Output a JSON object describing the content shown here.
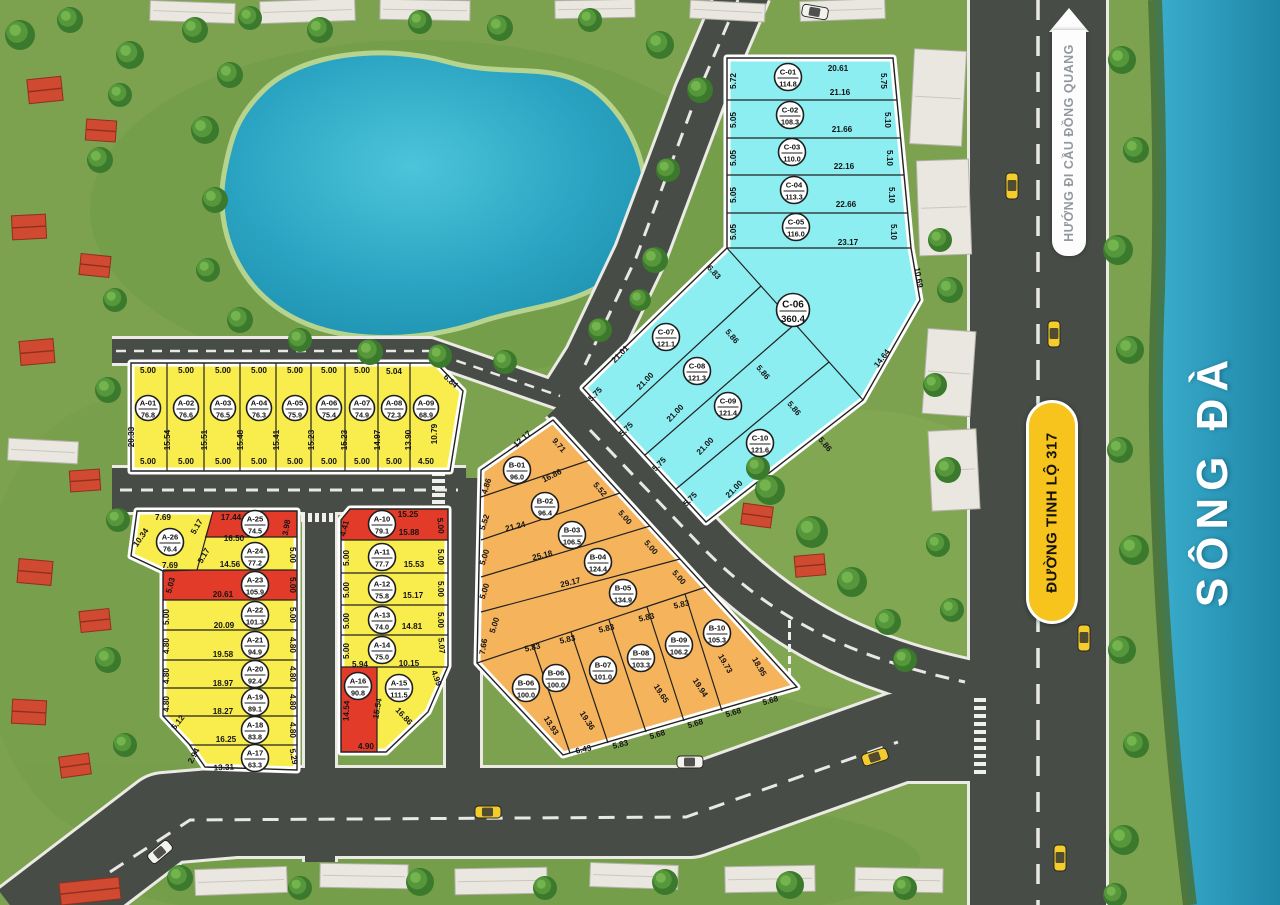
{
  "palette": {
    "plot_yellow": "#f9ed4e",
    "plot_red": "#e23b2a",
    "plot_orange": "#f5b45b",
    "plot_cyan": "#8deef2",
    "road_gray": "#474c47",
    "grass_green": "#7ca24f",
    "water_blue": "#2b9fc0",
    "sign_yellow": "#f6c41c"
  },
  "signs": {
    "road": "ĐƯỜNG TINH LỘ 317",
    "direction": "HƯỚNG ĐI CẦU ĐỒNG QUANG",
    "river": "SÔNG ĐÀ"
  },
  "plots": [
    [
      "A-01",
      "76.8",
      "y",
      148,
      408
    ],
    [
      "A-02",
      "76.6",
      "y",
      186,
      408
    ],
    [
      "A-03",
      "76.5",
      "y",
      223,
      408
    ],
    [
      "A-04",
      "76.3",
      "y",
      259,
      408
    ],
    [
      "A-05",
      "75.9",
      "y",
      295,
      408
    ],
    [
      "A-06",
      "75.4",
      "y",
      329,
      408
    ],
    [
      "A-07",
      "74.9",
      "y",
      362,
      408
    ],
    [
      "A-08",
      "72.3",
      "y",
      394,
      408
    ],
    [
      "A-09",
      "68.9",
      "y",
      426,
      408
    ],
    [
      "A-10",
      "79.1",
      "r",
      382,
      524
    ],
    [
      "A-11",
      "77.7",
      "y",
      382,
      557
    ],
    [
      "A-12",
      "75.8",
      "y",
      382,
      589
    ],
    [
      "A-13",
      "74.0",
      "y",
      382,
      620
    ],
    [
      "A-14",
      "75.0",
      "y",
      382,
      650
    ],
    [
      "A-15",
      "111.5",
      "y",
      399,
      688
    ],
    [
      "A-16",
      "90.8",
      "r",
      358,
      686
    ],
    [
      "A-17",
      "63.3",
      "y",
      255,
      758
    ],
    [
      "A-18",
      "83.8",
      "y",
      255,
      730
    ],
    [
      "A-19",
      "89.1",
      "y",
      255,
      702
    ],
    [
      "A-20",
      "92.4",
      "y",
      255,
      674
    ],
    [
      "A-21",
      "94.9",
      "y",
      255,
      645
    ],
    [
      "A-22",
      "101.3",
      "y",
      255,
      615
    ],
    [
      "A-23",
      "105.9",
      "r",
      255,
      585
    ],
    [
      "A-24",
      "77.2",
      "y",
      255,
      556
    ],
    [
      "A-25",
      "74.5",
      "r",
      255,
      524
    ],
    [
      "A-26",
      "76.4",
      "y",
      170,
      542
    ],
    [
      "B-01",
      "96.0",
      "o",
      517,
      470
    ],
    [
      "B-02",
      "96.4",
      "o",
      545,
      506
    ],
    [
      "B-03",
      "106.5",
      "o",
      572,
      535
    ],
    [
      "B-04",
      "124.4",
      "o",
      598,
      562
    ],
    [
      "B-05",
      "134.9",
      "o",
      623,
      593
    ],
    [
      "B-06",
      "100.0",
      "o",
      526,
      688
    ],
    [
      "B-06",
      "100.0",
      "o",
      556,
      678
    ],
    [
      "B-07",
      "101.0",
      "o",
      603,
      670
    ],
    [
      "B-08",
      "103.3",
      "o",
      641,
      658
    ],
    [
      "B-09",
      "106.2",
      "o",
      679,
      645
    ],
    [
      "B-10",
      "105.3",
      "o",
      717,
      633
    ],
    [
      "C-01",
      "114.8",
      "c",
      788,
      77
    ],
    [
      "C-02",
      "108.3",
      "c",
      790,
      115
    ],
    [
      "C-03",
      "110.0",
      "c",
      792,
      152
    ],
    [
      "C-04",
      "113.3",
      "c",
      794,
      190
    ],
    [
      "C-05",
      "116.0",
      "c",
      796,
      227
    ],
    [
      "C-06",
      "360.4",
      "c",
      793,
      310
    ],
    [
      "C-07",
      "121.1",
      "c",
      666,
      337
    ],
    [
      "C-08",
      "121.3",
      "c",
      697,
      371
    ],
    [
      "C-09",
      "121.4",
      "c",
      728,
      406
    ],
    [
      "C-10",
      "121.6",
      "c",
      760,
      443
    ]
  ],
  "dims": [
    [
      "5.00",
      148,
      373,
      0
    ],
    [
      "5.00",
      186,
      373,
      0
    ],
    [
      "5.00",
      223,
      373,
      0
    ],
    [
      "5.00",
      259,
      373,
      0
    ],
    [
      "5.00",
      295,
      373,
      0
    ],
    [
      "5.00",
      329,
      373,
      0
    ],
    [
      "5.00",
      362,
      373,
      0
    ],
    [
      "5.04",
      394,
      374,
      0
    ],
    [
      "6.84",
      449,
      383,
      42
    ],
    [
      "5.00",
      148,
      464,
      0
    ],
    [
      "5.00",
      186,
      464,
      0
    ],
    [
      "5.00",
      223,
      464,
      0
    ],
    [
      "5.00",
      259,
      464,
      0
    ],
    [
      "5.00",
      295,
      464,
      0
    ],
    [
      "5.00",
      329,
      464,
      0
    ],
    [
      "5.00",
      362,
      464,
      0
    ],
    [
      "5.00",
      394,
      464,
      0
    ],
    [
      "4.50",
      426,
      464,
      0
    ],
    [
      "20.33",
      134,
      437,
      -90
    ],
    [
      "15.54",
      170,
      440,
      -90
    ],
    [
      "15.51",
      207,
      440,
      -90
    ],
    [
      "15.48",
      243,
      440,
      -90
    ],
    [
      "15.41",
      279,
      440,
      -90
    ],
    [
      "15.23",
      314,
      440,
      -90
    ],
    [
      "15.23",
      347,
      440,
      -90
    ],
    [
      "14.97",
      380,
      440,
      -90
    ],
    [
      "13.90",
      411,
      440,
      -90
    ],
    [
      "10.79",
      437,
      434,
      -90
    ],
    [
      "7.69",
      163,
      520,
      0
    ],
    [
      "17.44",
      231,
      520,
      0
    ],
    [
      "5.17",
      199,
      528,
      -60
    ],
    [
      "3.98",
      289,
      528,
      -80
    ],
    [
      "10.34",
      143,
      539,
      -55
    ],
    [
      "16.50",
      234,
      541,
      0
    ],
    [
      "5.17",
      206,
      557,
      -60
    ],
    [
      "14.56",
      230,
      567,
      0
    ],
    [
      "5.00",
      290,
      555,
      90
    ],
    [
      "7.69",
      170,
      568,
      0
    ],
    [
      "5.03",
      173,
      586,
      -75
    ],
    [
      "20.61",
      223,
      597,
      0
    ],
    [
      "5.00",
      290,
      585,
      90
    ],
    [
      "5.00",
      169,
      617,
      -90
    ],
    [
      "20.09",
      224,
      628,
      0
    ],
    [
      "5.00",
      290,
      615,
      90
    ],
    [
      "4.80",
      169,
      646,
      -90
    ],
    [
      "19.58",
      223,
      657,
      0
    ],
    [
      "4.80",
      290,
      645,
      90
    ],
    [
      "4.80",
      169,
      676,
      -90
    ],
    [
      "18.97",
      223,
      686,
      0
    ],
    [
      "4.80",
      290,
      674,
      90
    ],
    [
      "4.80",
      169,
      704,
      -90
    ],
    [
      "18.27",
      223,
      714,
      0
    ],
    [
      "4.80",
      290,
      702,
      90
    ],
    [
      "5.12",
      180,
      724,
      -52
    ],
    [
      "16.25",
      226,
      742,
      0
    ],
    [
      "4.80",
      290,
      730,
      90
    ],
    [
      "2.94",
      196,
      757,
      -62
    ],
    [
      "13.31",
      224,
      770,
      -3
    ],
    [
      "5.29",
      291,
      757,
      80
    ],
    [
      "15.25",
      408,
      517,
      0
    ],
    [
      "15.88",
      409,
      535,
      0
    ],
    [
      "4.41",
      347,
      529,
      -75
    ],
    [
      "5.00",
      438,
      526,
      85
    ],
    [
      "5.00",
      349,
      558,
      -90
    ],
    [
      "15.53",
      414,
      567,
      0
    ],
    [
      "5.00",
      438,
      557,
      90
    ],
    [
      "5.00",
      349,
      590,
      -90
    ],
    [
      "15.17",
      413,
      598,
      0
    ],
    [
      "5.00",
      438,
      589,
      90
    ],
    [
      "5.00",
      349,
      621,
      -90
    ],
    [
      "14.81",
      412,
      629,
      0
    ],
    [
      "5.00",
      438,
      620,
      90
    ],
    [
      "5.00",
      349,
      651,
      -90
    ],
    [
      "5.07",
      439,
      646,
      85
    ],
    [
      "5.94",
      360,
      667,
      0
    ],
    [
      "10.15",
      409,
      666,
      0
    ],
    [
      "4.99",
      434,
      679,
      70
    ],
    [
      "14.54",
      349,
      711,
      -87
    ],
    [
      "15.54",
      380,
      709,
      -80
    ],
    [
      "16.86",
      402,
      718,
      47
    ],
    [
      "4.90",
      366,
      749,
      0
    ],
    [
      "12.17",
      524,
      441,
      -42
    ],
    [
      "9.71",
      557,
      447,
      49
    ],
    [
      "4.86",
      489,
      487,
      -72
    ],
    [
      "16.86",
      553,
      478,
      -27
    ],
    [
      "5.52",
      487,
      523,
      -72
    ],
    [
      "21.24",
      516,
      529,
      -14
    ],
    [
      "5.52",
      598,
      491,
      49
    ],
    [
      "5.00",
      487,
      558,
      -72
    ],
    [
      "25.18",
      543,
      558,
      -14
    ],
    [
      "5.00",
      623,
      519,
      49
    ],
    [
      "5.00",
      487,
      592,
      -72
    ],
    [
      "29.17",
      571,
      585,
      -14
    ],
    [
      "5.00",
      649,
      549,
      49
    ],
    [
      "5.00",
      497,
      626,
      -72
    ],
    [
      "5.00",
      677,
      579,
      49
    ],
    [
      "7.66",
      486,
      647,
      -80
    ],
    [
      "5.83",
      533,
      650,
      -13
    ],
    [
      "5.83",
      568,
      642,
      -13
    ],
    [
      "5.83",
      607,
      631,
      -13
    ],
    [
      "5.83",
      647,
      620,
      -13
    ],
    [
      "5.83",
      682,
      607,
      -13
    ],
    [
      "13.93",
      549,
      727,
      57
    ],
    [
      "19.36",
      585,
      722,
      57
    ],
    [
      "19.65",
      659,
      695,
      57
    ],
    [
      "19.94",
      698,
      689,
      57
    ],
    [
      "19.73",
      723,
      665,
      60
    ],
    [
      "18.95",
      757,
      668,
      60
    ],
    [
      "6.43",
      584,
      752,
      -13
    ],
    [
      "5.83",
      621,
      747,
      -14
    ],
    [
      "5.68",
      658,
      737,
      -16
    ],
    [
      "5.68",
      696,
      726,
      -16
    ],
    [
      "5.68",
      734,
      715,
      -16
    ],
    [
      "5.68",
      771,
      703,
      -16
    ],
    [
      "20.61",
      838,
      71,
      0
    ],
    [
      "21.16",
      840,
      95,
      0
    ],
    [
      "21.66",
      842,
      132,
      0
    ],
    [
      "22.16",
      844,
      169,
      0
    ],
    [
      "22.66",
      846,
      207,
      0
    ],
    [
      "23.17",
      848,
      245,
      0
    ],
    [
      "5.72",
      736,
      81,
      -90
    ],
    [
      "5.05",
      736,
      120,
      -90
    ],
    [
      "5.05",
      736,
      158,
      -90
    ],
    [
      "5.05",
      736,
      195,
      -90
    ],
    [
      "5.05",
      736,
      232,
      -90
    ],
    [
      "5.75",
      881,
      81,
      90
    ],
    [
      "5.10",
      885,
      120,
      90
    ],
    [
      "5.10",
      887,
      158,
      90
    ],
    [
      "5.10",
      889,
      195,
      90
    ],
    [
      "5.10",
      891,
      232,
      90
    ],
    [
      "6.83",
      712,
      274,
      48
    ],
    [
      "10.69",
      916,
      278,
      80
    ],
    [
      "14.64",
      884,
      360,
      -52
    ],
    [
      "21.01",
      622,
      356,
      -46
    ],
    [
      "21.00",
      647,
      383,
      -46
    ],
    [
      "21.00",
      677,
      415,
      -46
    ],
    [
      "21.00",
      707,
      448,
      -46
    ],
    [
      "21.00",
      736,
      491,
      -46
    ],
    [
      "5.86",
      730,
      338,
      50
    ],
    [
      "5.86",
      761,
      374,
      50
    ],
    [
      "5.86",
      792,
      410,
      50
    ],
    [
      "5.86",
      823,
      446,
      50
    ],
    [
      "5.75",
      597,
      396,
      -46
    ],
    [
      "5.75",
      628,
      431,
      -46
    ],
    [
      "5.75",
      661,
      466,
      -46
    ],
    [
      "5.75",
      692,
      501,
      -46
    ]
  ]
}
